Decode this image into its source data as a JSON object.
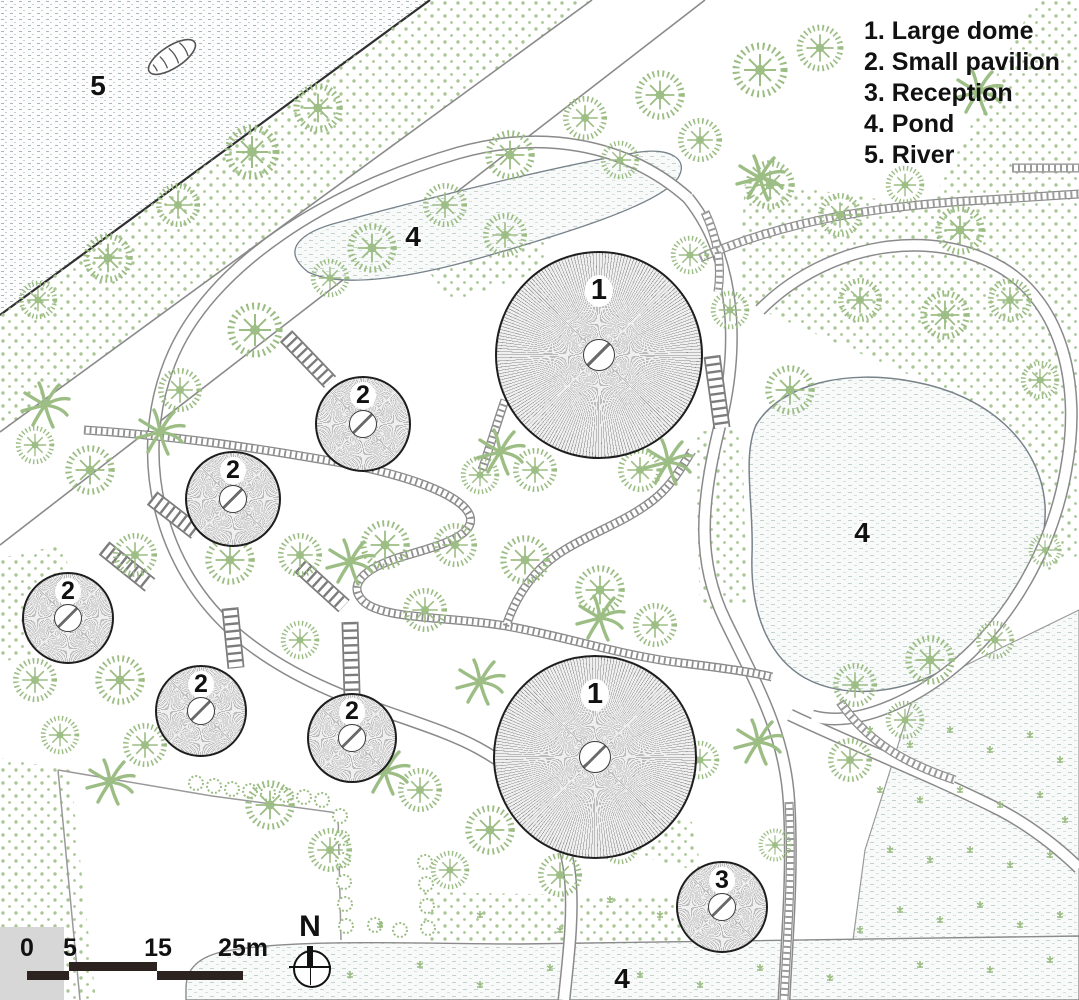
{
  "legend": {
    "items": [
      "1. Large dome",
      "2. Small pavilion",
      "3. Reception",
      "4. Pond",
      "5. River"
    ]
  },
  "area_labels": {
    "river": "5",
    "pond_top": "4",
    "pond_right": "4",
    "pond_bottom": "4"
  },
  "structures": [
    {
      "type": "large-dome",
      "label": "1",
      "x": 599,
      "y": 355,
      "r": 104
    },
    {
      "type": "large-dome",
      "label": "1",
      "x": 595,
      "y": 757,
      "r": 102
    },
    {
      "type": "small-pavilion",
      "label": "2",
      "x": 363,
      "y": 424,
      "r": 48
    },
    {
      "type": "small-pavilion",
      "label": "2",
      "x": 233,
      "y": 499,
      "r": 48
    },
    {
      "type": "small-pavilion",
      "label": "2",
      "x": 68,
      "y": 618,
      "r": 46
    },
    {
      "type": "small-pavilion",
      "label": "2",
      "x": 201,
      "y": 711,
      "r": 46
    },
    {
      "type": "small-pavilion",
      "label": "2",
      "x": 352,
      "y": 738,
      "r": 45
    },
    {
      "type": "reception",
      "label": "3",
      "x": 722,
      "y": 907,
      "r": 46
    }
  ],
  "scale_bar": {
    "ticks": [
      "0",
      "5",
      "15",
      "25m"
    ]
  },
  "compass": {
    "label": "N"
  },
  "colors": {
    "vegetation": "#9cbd84",
    "veg_dots": "#a9c795",
    "water_fleck": "#b9c9c4",
    "ink": "#1e1e1e",
    "path_gray": "#8a8a8a"
  }
}
